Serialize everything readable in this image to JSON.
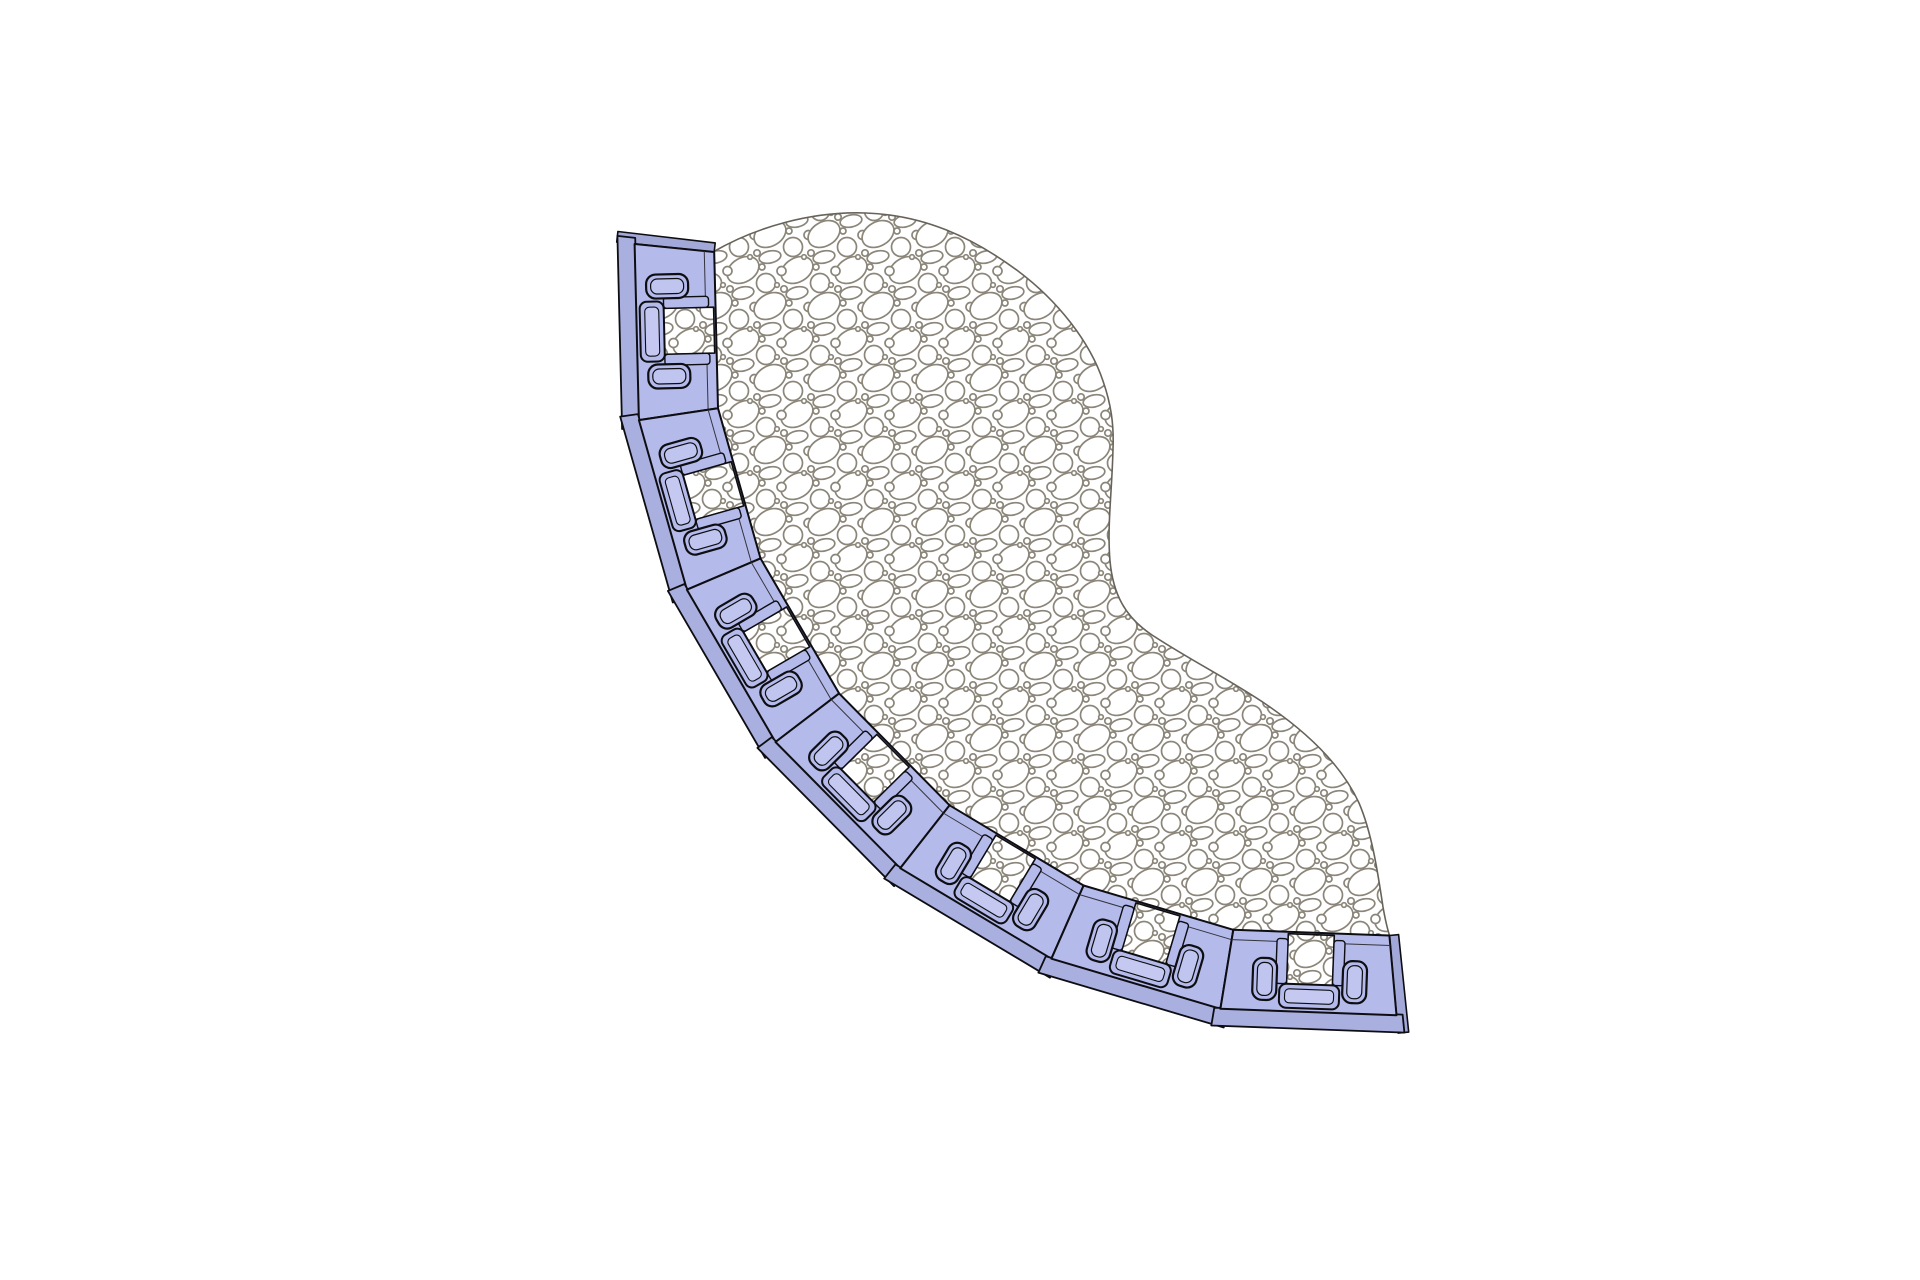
{
  "drawing": {
    "type": "cad-plan-view",
    "description_name": "gravel-surface-with-edging-blocks",
    "canvas_background": "#ffffff",
    "surface": {
      "fill": "#ffffff",
      "outline_color": "#67635a",
      "outline_width": 1.6,
      "path": "M 713 252 C 756 227, 812 211, 866 213 C 924 215, 972 237, 1018 271 C 1058 301, 1090 342, 1103 381 C 1111 404, 1114 424, 1113 449 C 1112 492, 1107 526, 1110 561 C 1113 594, 1125 617, 1152 635 C 1190 660, 1232 681, 1267 705 C 1308 733, 1342 766, 1359 803 C 1372 833, 1378 874, 1383 907 C 1386 924, 1388 931, 1390 937 A 624 624 0 0 1 713 252 Z",
      "texture": {
        "name": "gravel-hatch",
        "stroke": "#8b8679",
        "stroke_width": 1.7,
        "pebble_fill": "#ffffff",
        "tile": {
          "width": 54,
          "height": 72
        },
        "shapes": [
          {
            "cx": 14,
            "cy": 18,
            "rx": 17,
            "ry": 12,
            "rot": -30
          },
          {
            "cx": 41,
            "cy": 54,
            "rx": 17,
            "ry": 12,
            "rot": -30
          },
          {
            "cx": 37,
            "cy": 31,
            "rx": 9.5,
            "ry": 9.5,
            "rot": 0
          },
          {
            "cx": 10,
            "cy": 67,
            "rx": 9.5,
            "ry": 9.5,
            "rot": 0
          },
          {
            "cx": 41,
            "cy": 5,
            "rx": 11,
            "ry": 6,
            "rot": -12
          },
          {
            "cx": 14,
            "cy": 41,
            "rx": 11,
            "ry": 6,
            "rot": -12
          },
          {
            "cx": 52.5,
            "cy": 19,
            "rx": 4.5,
            "ry": 4.5,
            "rot": 0
          },
          {
            "cx": 25.5,
            "cy": 55,
            "rx": 4.5,
            "ry": 4.5,
            "rot": 0
          },
          {
            "cx": 28,
            "cy": 1,
            "rx": 3.2,
            "ry": 3.2,
            "rot": 0
          },
          {
            "cx": 1,
            "cy": 37,
            "rx": 3.2,
            "ry": 3.2,
            "rot": 0
          },
          {
            "cx": 48,
            "cy": 41,
            "rx": 2.3,
            "ry": 2.3,
            "rot": 0
          },
          {
            "cx": 21,
            "cy": 69,
            "rx": 2.3,
            "ry": 2.3,
            "rot": 0
          },
          {
            "cx": 33,
            "cy": 15,
            "rx": 3,
            "ry": 3,
            "rot": 0
          },
          {
            "cx": 6,
            "cy": 51,
            "rx": 3,
            "ry": 3,
            "rot": 0
          }
        ]
      }
    },
    "edging": {
      "block_count": 7,
      "color_face": "#b4baea",
      "color_flange": "#a9afdf",
      "color_endcap": "#a2a8d8",
      "color_channel": "#c5c9f2",
      "color_slot_inner": "#c0c5ef",
      "outline_color": "#0d0d12",
      "detail_line_color": "#34343e",
      "center": {
        "x": 1334,
        "y": 315
      },
      "radius_inner": 623,
      "radius_outer": 703,
      "radius_flange": 721,
      "boundaries_deg": [
        185.8,
        171.4,
        157.0,
        142.6,
        128.1,
        113.7,
        99.3,
        84.9
      ],
      "flange_overhang_deg": 0.5,
      "endcap_deg": 0.85,
      "features": {
        "inner_step_offset": 10,
        "opening": {
          "half_width": 23,
          "depth": 50,
          "overhang": 3
        },
        "rail": {
          "gap": 23,
          "width": 11,
          "y0": -47,
          "height": 45,
          "rx": 3
        },
        "bridge": {
          "x": -30,
          "y": -71,
          "width": 60,
          "height": 24,
          "rx": 7,
          "inner_x": -24.5,
          "inner_y": -66,
          "inner_w": 49,
          "inner_h": 14,
          "inner_rx": 4.5
        },
        "slot": {
          "offset": 45,
          "x_half": 12,
          "y0": -64,
          "height": 42,
          "rx": 9.5,
          "inner_x_half": 7.5,
          "inner_y0": -59.5,
          "inner_h": 33,
          "inner_rx": 6.5
        }
      }
    }
  }
}
